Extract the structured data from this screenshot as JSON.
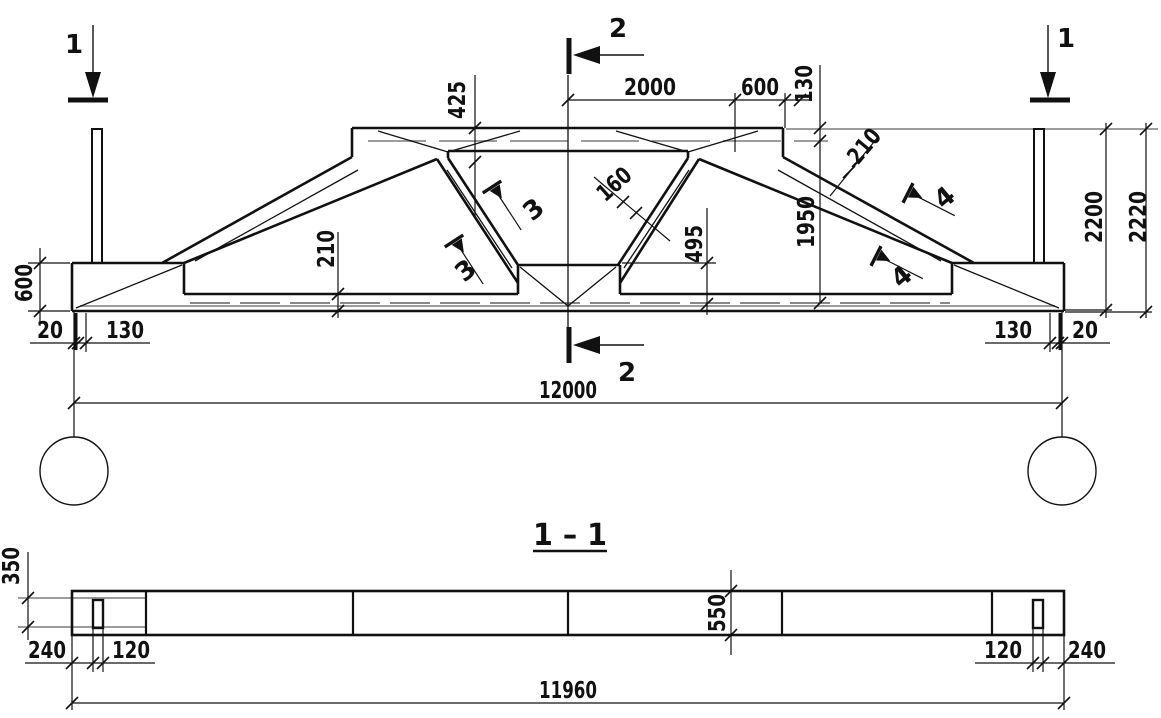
{
  "colors": {
    "ink": "#111111",
    "gray": "#9c9c9c",
    "background": "#ffffff"
  },
  "elevation": {
    "section_marks": {
      "cut1_left": "1",
      "cut1_right": "1",
      "cut2_top": "2",
      "cut2_bottom": "2",
      "cut3_upper": "3",
      "cut3_lower": "3",
      "cut4_upper": "4",
      "cut4_lower": "4"
    },
    "dims": {
      "plate_drop": "425",
      "top_center_half": "2000",
      "top_right": "600",
      "top_edge": "130",
      "chord_thickness": "210",
      "mid_height": "1950",
      "height_to_seat": "2200",
      "height_total": "2220",
      "web_thickness": "160",
      "node_height": "495",
      "bottom_chord": "210",
      "end_height": "600",
      "pad_left": "20",
      "seat_left": "130",
      "seat_right": "130",
      "pad_right": "20",
      "span": "12000"
    }
  },
  "section": {
    "title": "1 – 1",
    "dims": {
      "flange": "350",
      "end_left": "240",
      "embed_left": "120",
      "width": "550",
      "embed_right": "120",
      "end_right": "240",
      "length": "11960"
    }
  }
}
